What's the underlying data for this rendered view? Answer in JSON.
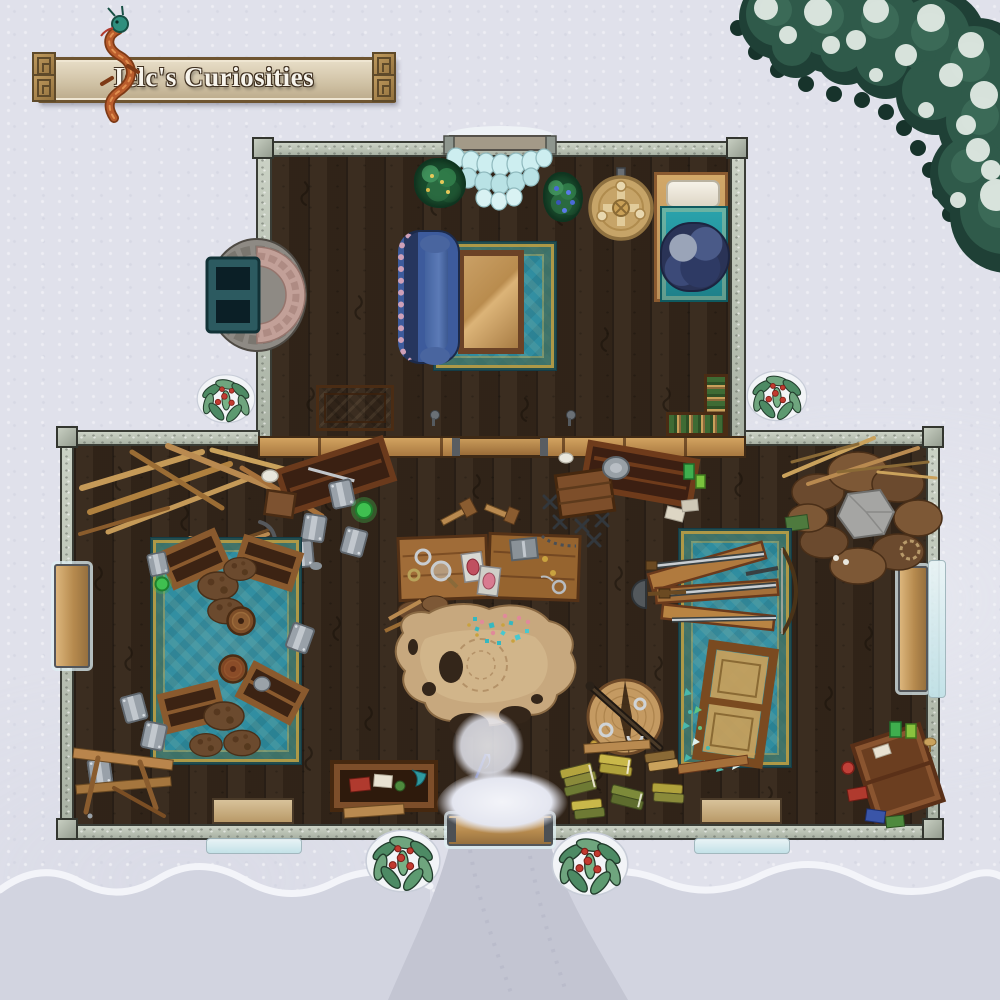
{
  "banner": {
    "title": "Ielc's Curiosities"
  },
  "colors": {
    "snow": "#e0e1eb",
    "snow_drift": "#d3d5e1",
    "snow_path": "#c3c5d2",
    "wall_stone": "#b6beb2",
    "wall_edge": "#3a3d36",
    "floor_wood": "#34261a",
    "divider_wood": "#b9854c",
    "rug_teal": "#2f8da0",
    "rug_gold": "#c9a23f",
    "couch_blue": "#3d5b9c",
    "bed_teal": "#2aa3ac",
    "cloth_navy": "#2e3a64",
    "parchment": "#c7a87e",
    "pine_green": "#2a5245",
    "holly_green": "#4d8a64",
    "berry_red": "#c23a30",
    "banner_bronze": "#9a7a48",
    "banner_parchment": "#d6c9ab",
    "dragon_orange": "#b95c2c",
    "dragon_teal": "#2f8f7e",
    "potion_green": "#3fc050",
    "gem_teal": "#35b8c0",
    "gem_pink": "#e08a9a",
    "metal_grey": "#99a1a9",
    "gold": "#c9a23f"
  }
}
